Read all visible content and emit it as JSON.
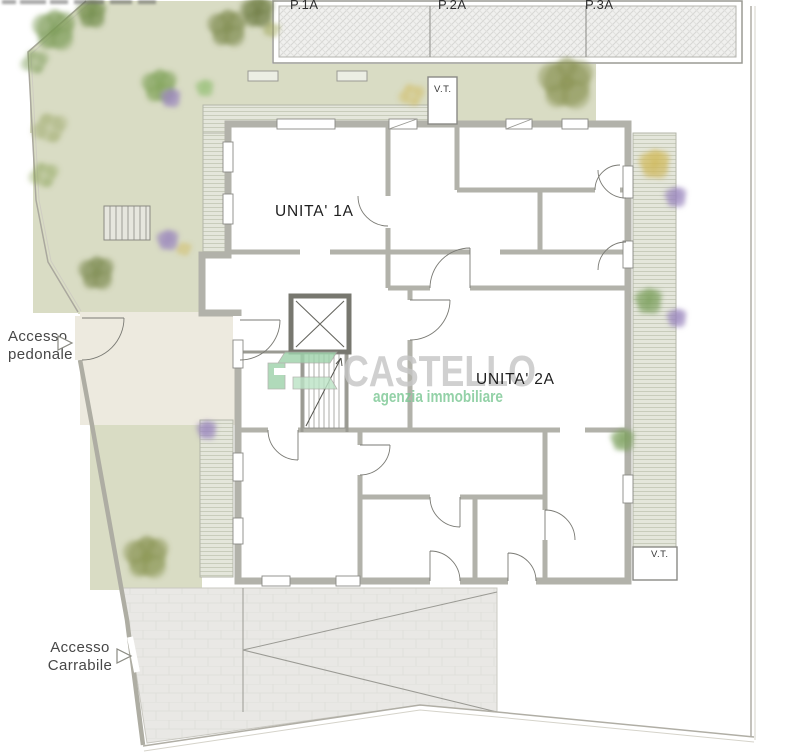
{
  "plan": {
    "title_watermark": {
      "brand": "CASTELLO",
      "tagline": "agenzia immobiliare",
      "brand_color": "#c6c6c6",
      "tagline_color": "#7cc894",
      "logo_color": "#9fd3ac",
      "logo_color_light": "#bce3c6"
    },
    "units": {
      "unit_1a": "UNITA' 1A",
      "unit_2a": "UNITA' 2A"
    },
    "parking": {
      "stall_1": "P.1A",
      "stall_2": "P.2A",
      "stall_3": "P.3A"
    },
    "technical_rooms": {
      "vt_top": "V.T.",
      "vt_bottom": "V.T."
    },
    "access": {
      "pedestrian_line1": "Accesso",
      "pedestrian_line2": "pedonale",
      "vehicle_line1": "Accesso",
      "vehicle_line2": "Carrabile"
    },
    "colors": {
      "garden": "#d9dcc4",
      "courtyard": "#edeadf",
      "deck": "#e4e6db",
      "driveway": "#e9e8e5",
      "wall": "#b2b2aa",
      "parking_fill": "#f0f0ee"
    }
  }
}
